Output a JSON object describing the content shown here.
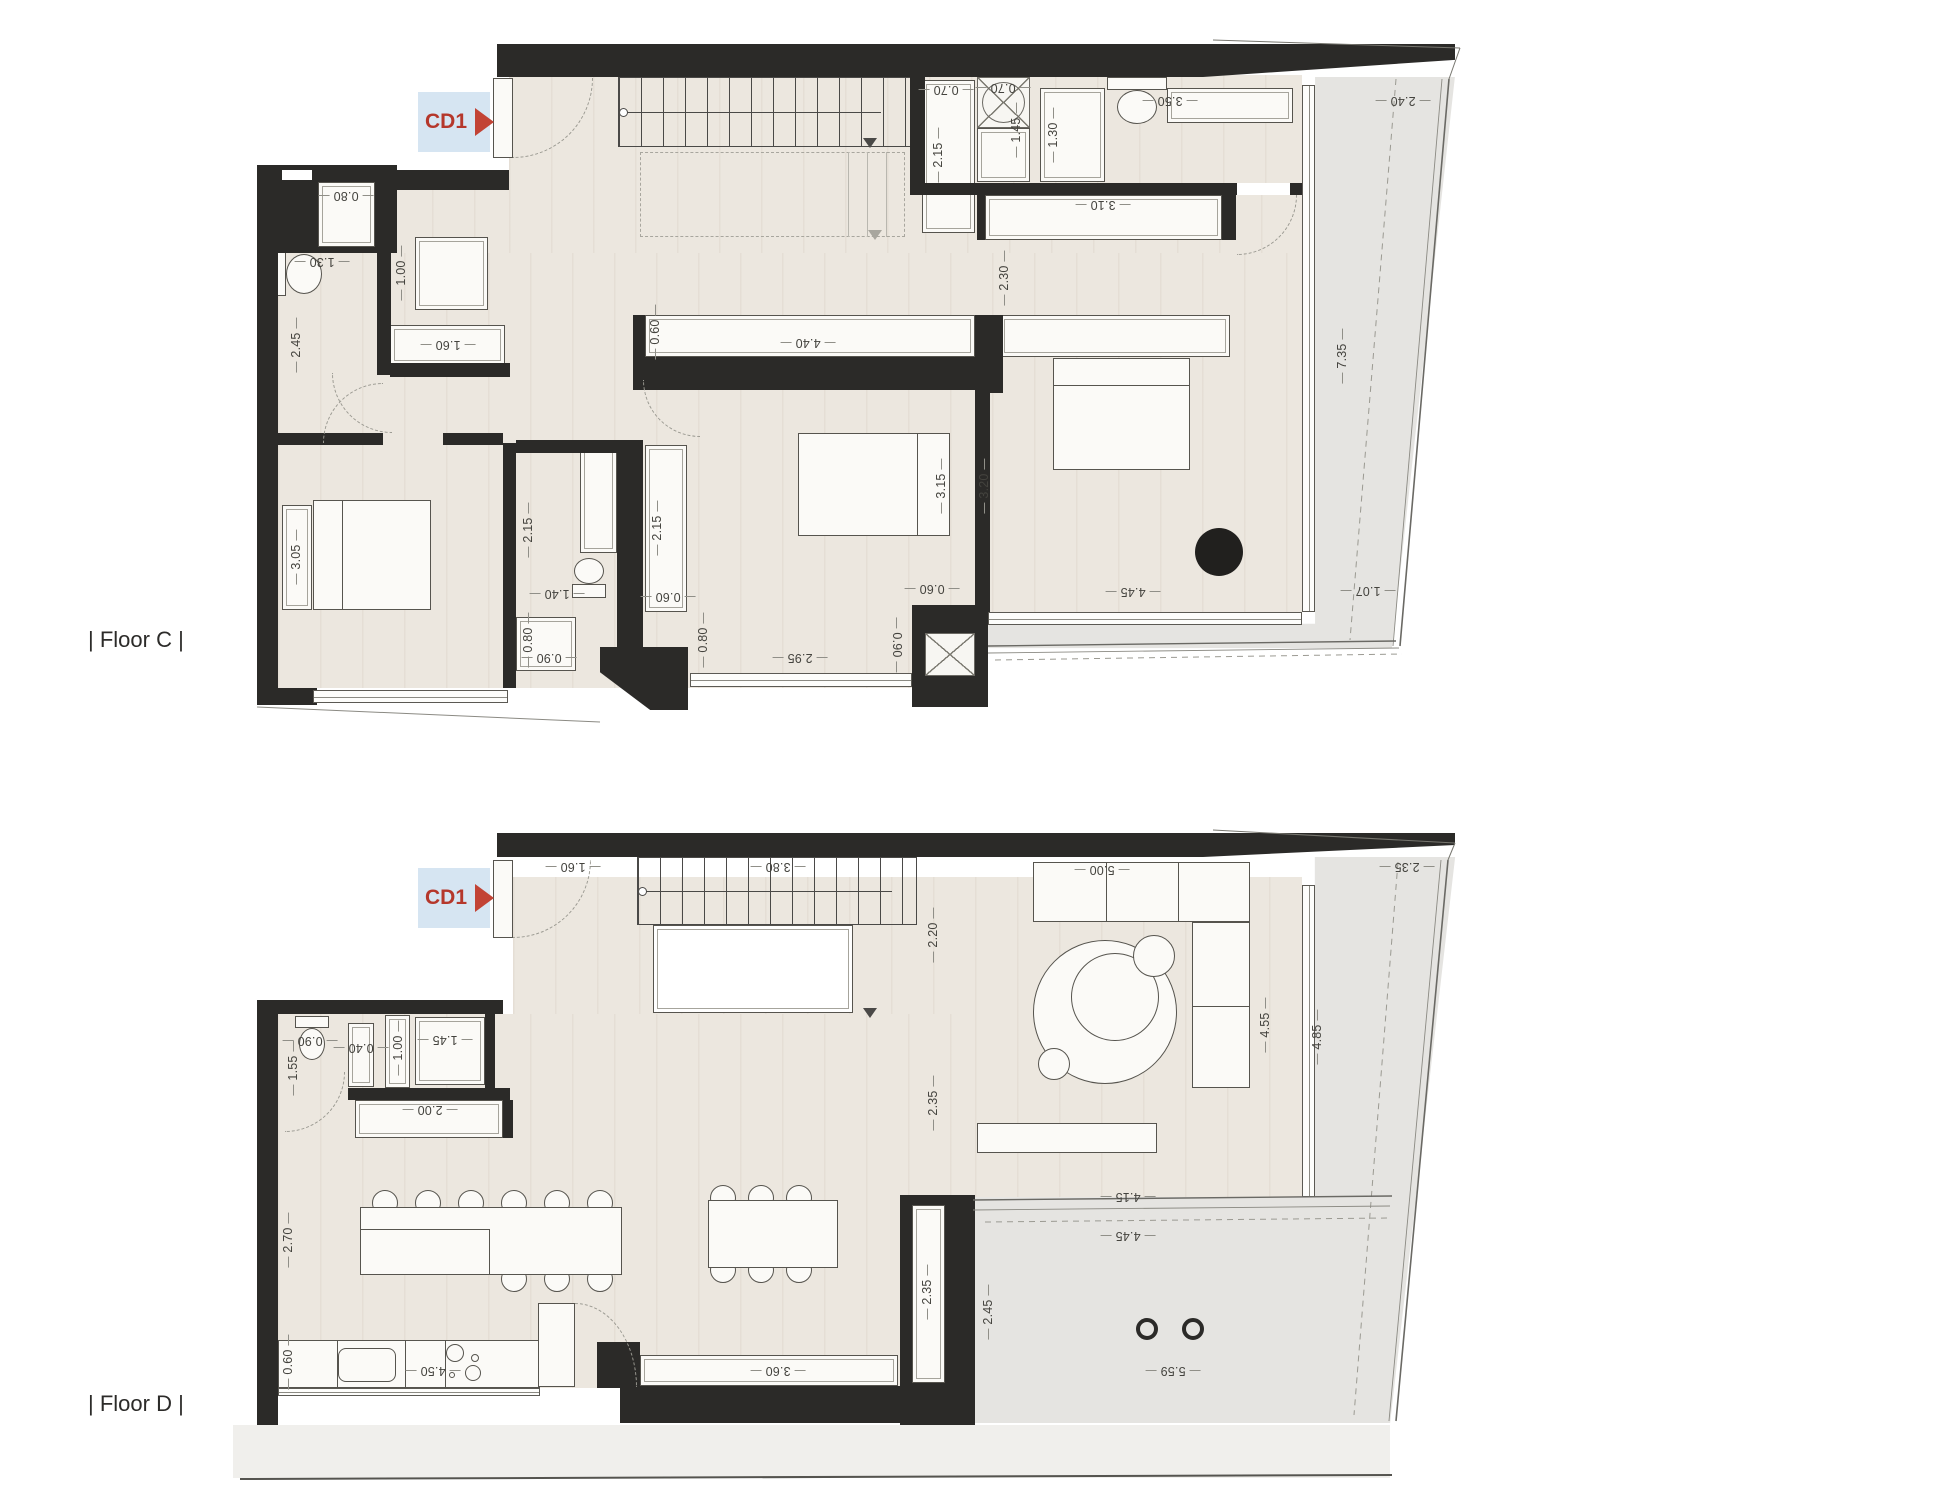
{
  "page": {
    "background": "#ffffff"
  },
  "colors": {
    "wall": "#2b2a28",
    "floor_wood": "#ece7df",
    "terrace": "#e5e4e1",
    "marker_text": "#b5372b",
    "marker_bg": "#cbdeee",
    "dim_text": "#44433e"
  },
  "floors": [
    {
      "id": "floor-c",
      "label": "| Floor C |",
      "marker": "CD1",
      "dims": [
        {
          "t": "0.80",
          "x": 346,
          "y": 196,
          "r": 180
        },
        {
          "t": "1.30",
          "x": 322,
          "y": 262,
          "r": 180
        },
        {
          "t": "1.00",
          "x": 401,
          "y": 273,
          "r": -90
        },
        {
          "t": "1.60",
          "x": 448,
          "y": 345,
          "r": 180
        },
        {
          "t": "2.45",
          "x": 296,
          "y": 345,
          "r": -90
        },
        {
          "t": "3.05",
          "x": 296,
          "y": 557,
          "r": -90
        },
        {
          "t": "2.15",
          "x": 528,
          "y": 530,
          "r": -90
        },
        {
          "t": "1.40",
          "x": 557,
          "y": 594,
          "r": 180
        },
        {
          "t": "0.80",
          "x": 528,
          "y": 640,
          "r": -90
        },
        {
          "t": "0.90",
          "x": 549,
          "y": 658,
          "r": 180
        },
        {
          "t": "2.15",
          "x": 657,
          "y": 528,
          "r": -90
        },
        {
          "t": "0.60",
          "x": 668,
          "y": 597,
          "r": 180
        },
        {
          "t": "0.80",
          "x": 703,
          "y": 640,
          "r": -90
        },
        {
          "t": "2.95",
          "x": 800,
          "y": 658,
          "r": 180
        },
        {
          "t": "0.90",
          "x": 897,
          "y": 645,
          "r": 90
        },
        {
          "t": "0.60",
          "x": 932,
          "y": 589,
          "r": 180
        },
        {
          "t": "0.60",
          "x": 655,
          "y": 332,
          "r": -90
        },
        {
          "t": "4.40",
          "x": 808,
          "y": 343,
          "r": 180
        },
        {
          "t": "3.15",
          "x": 941,
          "y": 486,
          "r": -90
        },
        {
          "t": "3.20",
          "x": 984,
          "y": 486,
          "r": -90
        },
        {
          "t": "0.70",
          "x": 946,
          "y": 90,
          "r": 180
        },
        {
          "t": "0.70",
          "x": 1003,
          "y": 88,
          "r": 180
        },
        {
          "t": "2.15",
          "x": 938,
          "y": 155,
          "r": -90
        },
        {
          "t": "1.45",
          "x": 1016,
          "y": 130,
          "r": -90
        },
        {
          "t": "1.30",
          "x": 1053,
          "y": 135,
          "r": -90
        },
        {
          "t": "3.50",
          "x": 1170,
          "y": 101,
          "r": 180
        },
        {
          "t": "3.10",
          "x": 1103,
          "y": 205,
          "r": 180
        },
        {
          "t": "2.30",
          "x": 1004,
          "y": 278,
          "r": -90
        },
        {
          "t": "2.40",
          "x": 1403,
          "y": 101,
          "r": 180
        },
        {
          "t": "7.35",
          "x": 1342,
          "y": 356,
          "r": -90
        },
        {
          "t": "4.45",
          "x": 1133,
          "y": 592,
          "r": 180
        },
        {
          "t": "1.07",
          "x": 1368,
          "y": 591,
          "r": 180
        }
      ]
    },
    {
      "id": "floor-d",
      "label": "| Floor D |",
      "marker": "CD1",
      "dims": [
        {
          "t": "1.60",
          "x": 573,
          "y": 867,
          "r": 180
        },
        {
          "t": "3.80",
          "x": 778,
          "y": 867,
          "r": 180
        },
        {
          "t": "0.90",
          "x": 310,
          "y": 1041,
          "r": 180
        },
        {
          "t": "1.55",
          "x": 293,
          "y": 1068,
          "r": -90
        },
        {
          "t": "0.40",
          "x": 361,
          "y": 1048,
          "r": 180
        },
        {
          "t": "1.00",
          "x": 398,
          "y": 1048,
          "r": -90
        },
        {
          "t": "1.45",
          "x": 445,
          "y": 1040,
          "r": 180
        },
        {
          "t": "2.00",
          "x": 430,
          "y": 1110,
          "r": 180
        },
        {
          "t": "2.20",
          "x": 933,
          "y": 935,
          "r": -90
        },
        {
          "t": "2.35",
          "x": 933,
          "y": 1103,
          "r": -90
        },
        {
          "t": "5.00",
          "x": 1102,
          "y": 870,
          "r": 180
        },
        {
          "t": "4.55",
          "x": 1265,
          "y": 1025,
          "r": -90
        },
        {
          "t": "4.85",
          "x": 1317,
          "y": 1037,
          "r": -90
        },
        {
          "t": "2.35",
          "x": 1407,
          "y": 867,
          "r": 180
        },
        {
          "t": "2.70",
          "x": 288,
          "y": 1240,
          "r": -90
        },
        {
          "t": "0.60",
          "x": 288,
          "y": 1362,
          "r": -90
        },
        {
          "t": "4.50",
          "x": 433,
          "y": 1371,
          "r": 180
        },
        {
          "t": "3.60",
          "x": 778,
          "y": 1371,
          "r": 180
        },
        {
          "t": "2.35",
          "x": 927,
          "y": 1292,
          "r": -90
        },
        {
          "t": "2.45",
          "x": 988,
          "y": 1312,
          "r": -90
        },
        {
          "t": "4.15",
          "x": 1128,
          "y": 1197,
          "r": 180
        },
        {
          "t": "4.45",
          "x": 1128,
          "y": 1236,
          "r": 180
        },
        {
          "t": "5.59",
          "x": 1173,
          "y": 1371,
          "r": 180
        }
      ]
    }
  ]
}
